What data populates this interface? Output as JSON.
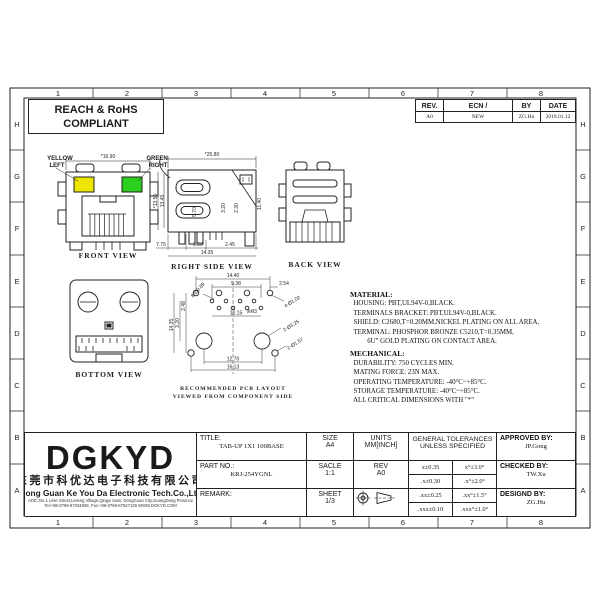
{
  "grid": {
    "cols": [
      "1",
      "2",
      "3",
      "4",
      "5",
      "6",
      "7",
      "8"
    ],
    "rows": [
      "H",
      "G",
      "F",
      "E",
      "D",
      "C",
      "B",
      "A"
    ]
  },
  "compliance": {
    "line1": "REACH & RoHS",
    "line2": "COMPLIANT"
  },
  "rev_table": {
    "h_rev": "REV.",
    "h_ecn": "ECN / DESCRIPTION",
    "h_by": "BY",
    "h_date": "DATE",
    "rev": "A0",
    "ecn": "NEW",
    "by": "ZG.Hu",
    "date": "2018.01.12"
  },
  "views": {
    "front": {
      "caption": "FRONT VIEW",
      "led_left_1": "YELLOW",
      "led_left_2": "LEFT",
      "led_right_1": "GREEN",
      "led_right_2": "RIGHT",
      "led_left_color": "#ede400",
      "led_right_color": "#2bd01e",
      "dim_width": "*16.90"
    },
    "right": {
      "caption": "RIGHT SIDE VIEW",
      "dim_width": "*25.80",
      "dim_h1": "*13.55",
      "dim_h2": "13.45",
      "dim_v1": "5.70",
      "dim_v2": "3.20",
      "dim_v3": "2.30",
      "dim_v4": "11.40",
      "dim_b1": "7.75",
      "dim_b2": "3.20",
      "dim_b3": "2.45",
      "dim_b4": "14.35"
    },
    "back": {
      "caption": "BACK VIEW"
    },
    "bottom": {
      "caption": "BOTTOM VIEW"
    },
    "pcb": {
      "caption1": "RECOMMENDED PCB LAYOUT",
      "caption2": "VIEWED FROM COMPONENT SIDE",
      "dim_top1": "14.40",
      "dim_top2": "9.38",
      "dim_top3": "2.54",
      "hole_a": "4-Ø1.02",
      "hole_b": "8-Ø0.89",
      "dim_m1": "2.03",
      "dim_m2": "10.15",
      "dim_l1": "14.35",
      "dim_l2": "3.20",
      "dim_l3": "2.48",
      "hole_c": "2-Ø3.25",
      "hole_d": "2-Ø1.57",
      "dim_b1": "12.70",
      "dim_b2": "16.13"
    }
  },
  "notes": {
    "material_title": "MATERIAL:",
    "material": [
      "  HOUSING: PBT,UL94V-0,BLACK.",
      "  TERMINALS BRACKET: PBT,UL94V-0,BLACK.",
      "  SHIELD: C2680,T=0.20MM,NICKEL PLATING ON ALL AREA.",
      "  TERMINAL: PHOSPHOR BRONZE C5210,T=0.35MM,",
      "          6U\" GOLD PLATING ON CONTACT AREA."
    ],
    "mechanical_title": "MECHANICAL:",
    "mechanical": [
      "  DURABILITY: 750 CYCLES MIN.",
      "  MATING FORCE: 23N MAX.",
      "  OPERATING TEMPERATURE: -40°C~+85°C.",
      "  STORAGE TEMPERATURE: -40°C~+85°C.",
      "  ALL CRITICAL DIMENSIONS WITH \"*\""
    ]
  },
  "title_block": {
    "logo": "DGKYD",
    "company_cn": "东莞市科优达电子科技有限公司",
    "company_en": "Dong Guan Ke You Da Electronic Tech.Co.,Ltd",
    "address1": "ADD.:No.1 LiHe Street,LiHeng Village,Qingxi town, DongGuan City,GuangDong Province",
    "address2": "Tel:+86-0769-87334608, Fax:+86-0769-87647129  WWW.DGKYD.COM",
    "title_label": "TITLE:",
    "title_value": "TAB-UP 1X1 100BASE",
    "part_label": "PART NO.:",
    "part_value": "KRJ-254YGNL",
    "remark_label": "REMARK:",
    "size_label": "SIZE",
    "size_value": "A4",
    "units_label": "UNITS",
    "units_value": "MM[INCH]",
    "scale_label": "SACLE",
    "scale_value": "1:1",
    "rev_label": "REV",
    "rev_value": "A0",
    "sheet_label": "SHEET",
    "sheet_value": "1/3",
    "tol_header1": "GENERAL TOLERANCES",
    "tol_header2": "UNLESS SPECIFIED",
    "tol": [
      [
        "x±0.35",
        "x°±3.0°"
      ],
      [
        ".x±0.30",
        ".x°±2.0°"
      ],
      [
        ".xx±0.25",
        ".xx°±1.5°"
      ],
      [
        ".xxx±0.10",
        ".xxx°±1.0°"
      ]
    ],
    "approved_label": "APPROVED BY:",
    "approved_value": "JP.Gong",
    "checked_label": "CHECKED BY:",
    "checked_value": "TW.Xu",
    "designed_label": "DESIGND BY:",
    "designed_value": "ZG.Hu"
  }
}
